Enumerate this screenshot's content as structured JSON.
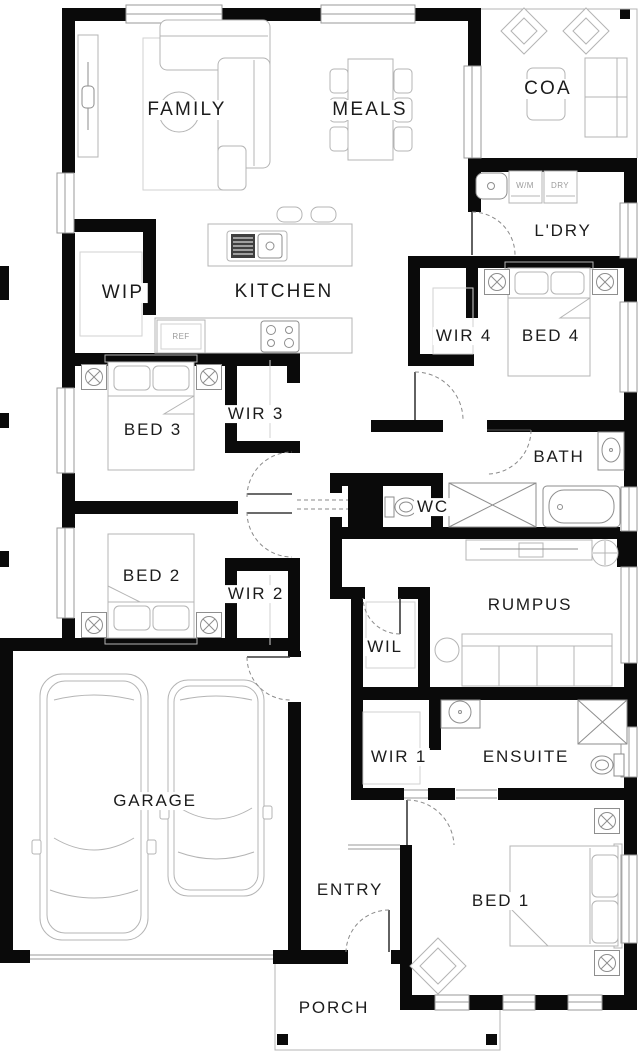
{
  "colors": {
    "wall": "#0a0a0a",
    "line": "#b4b4b4",
    "fixture": "#8e8e8e",
    "label": "#1c1c1c",
    "muted": "#9b9b9b",
    "bg": "#ffffff"
  },
  "rooms": {
    "family": {
      "label": "FAMILY"
    },
    "meals": {
      "label": "MEALS"
    },
    "coa": {
      "label": "COA"
    },
    "laundry": {
      "label": "L'DRY"
    },
    "wip": {
      "label": "WIP"
    },
    "kitchen": {
      "label": "KITCHEN"
    },
    "wir4": {
      "label": "WIR 4"
    },
    "bed4": {
      "label": "BED 4"
    },
    "bed3": {
      "label": "BED 3"
    },
    "wir3": {
      "label": "WIR 3"
    },
    "bath": {
      "label": "BATH"
    },
    "wc": {
      "label": "WC"
    },
    "bed2": {
      "label": "BED 2"
    },
    "wir2": {
      "label": "WIR 2"
    },
    "rumpus": {
      "label": "RUMPUS"
    },
    "wil": {
      "label": "WIL"
    },
    "garage": {
      "label": "GARAGE"
    },
    "wir1": {
      "label": "WIR 1"
    },
    "ensuite": {
      "label": "ENSUITE"
    },
    "entry": {
      "label": "ENTRY"
    },
    "bed1": {
      "label": "BED 1"
    },
    "porch": {
      "label": "PORCH"
    }
  },
  "appliances": {
    "washer": "W/M",
    "dryer": "DRY",
    "fridge": "REF"
  }
}
